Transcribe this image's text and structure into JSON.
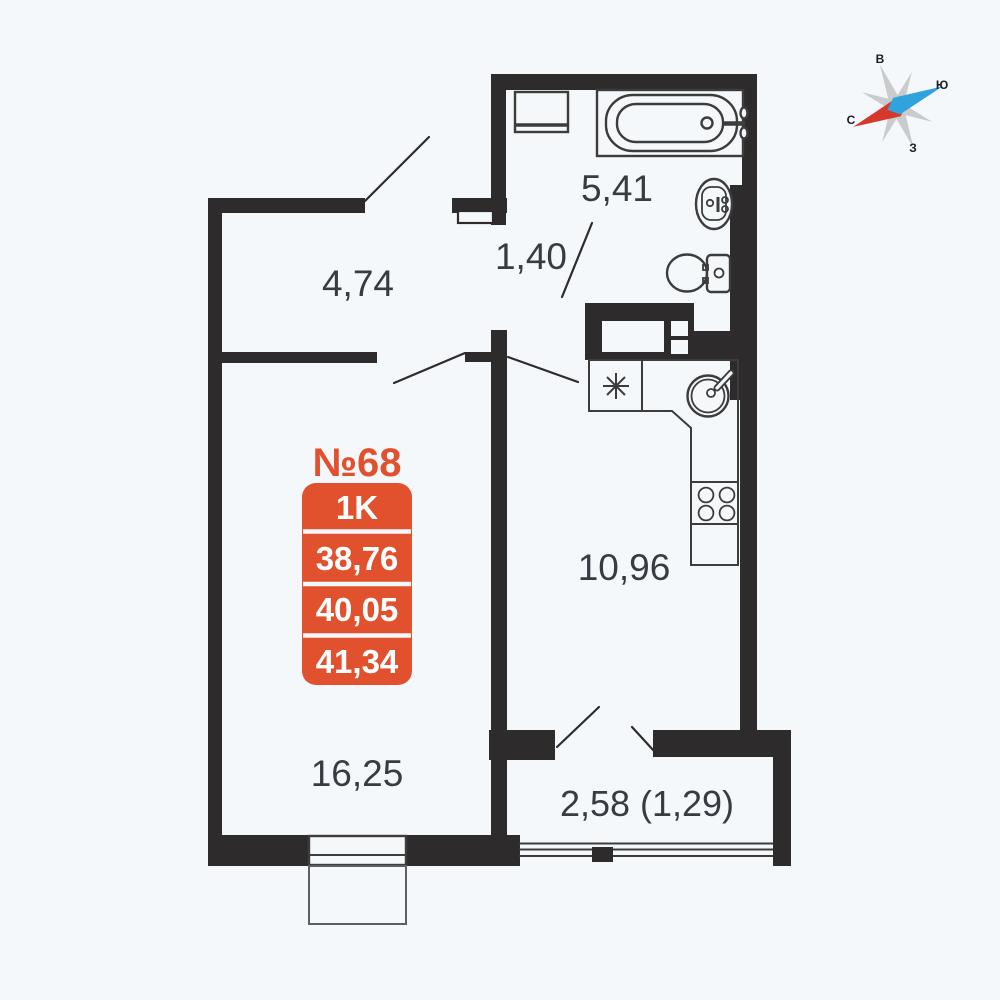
{
  "apartment": {
    "number": "№68",
    "badge": {
      "type": "1K",
      "area_rows": [
        "38,76",
        "40,05",
        "41,34"
      ]
    }
  },
  "rooms": {
    "hallway": {
      "area": "4,74"
    },
    "bathroom": {
      "area": "5,41"
    },
    "corridor": {
      "area": "1,40"
    },
    "kitchen": {
      "area": "10,96"
    },
    "living_room": {
      "area": "16,25"
    },
    "balcony": {
      "area": "2,58 (1,29)"
    }
  },
  "compass": {
    "top": "В",
    "right": "Ю",
    "left": "С",
    "bottom": "З"
  },
  "colors": {
    "background": "#f5f8fb",
    "floor": "#f5f8fb",
    "wall": "#2d2b2b",
    "line": "#3c3c3c",
    "text": "#383b42",
    "accent": "#e2512e",
    "badge_text": "#ffffff",
    "compass_north_red": "#d6392c",
    "compass_south_blue": "#2ea3dd",
    "compass_star_gray": "#c9cbcd"
  }
}
